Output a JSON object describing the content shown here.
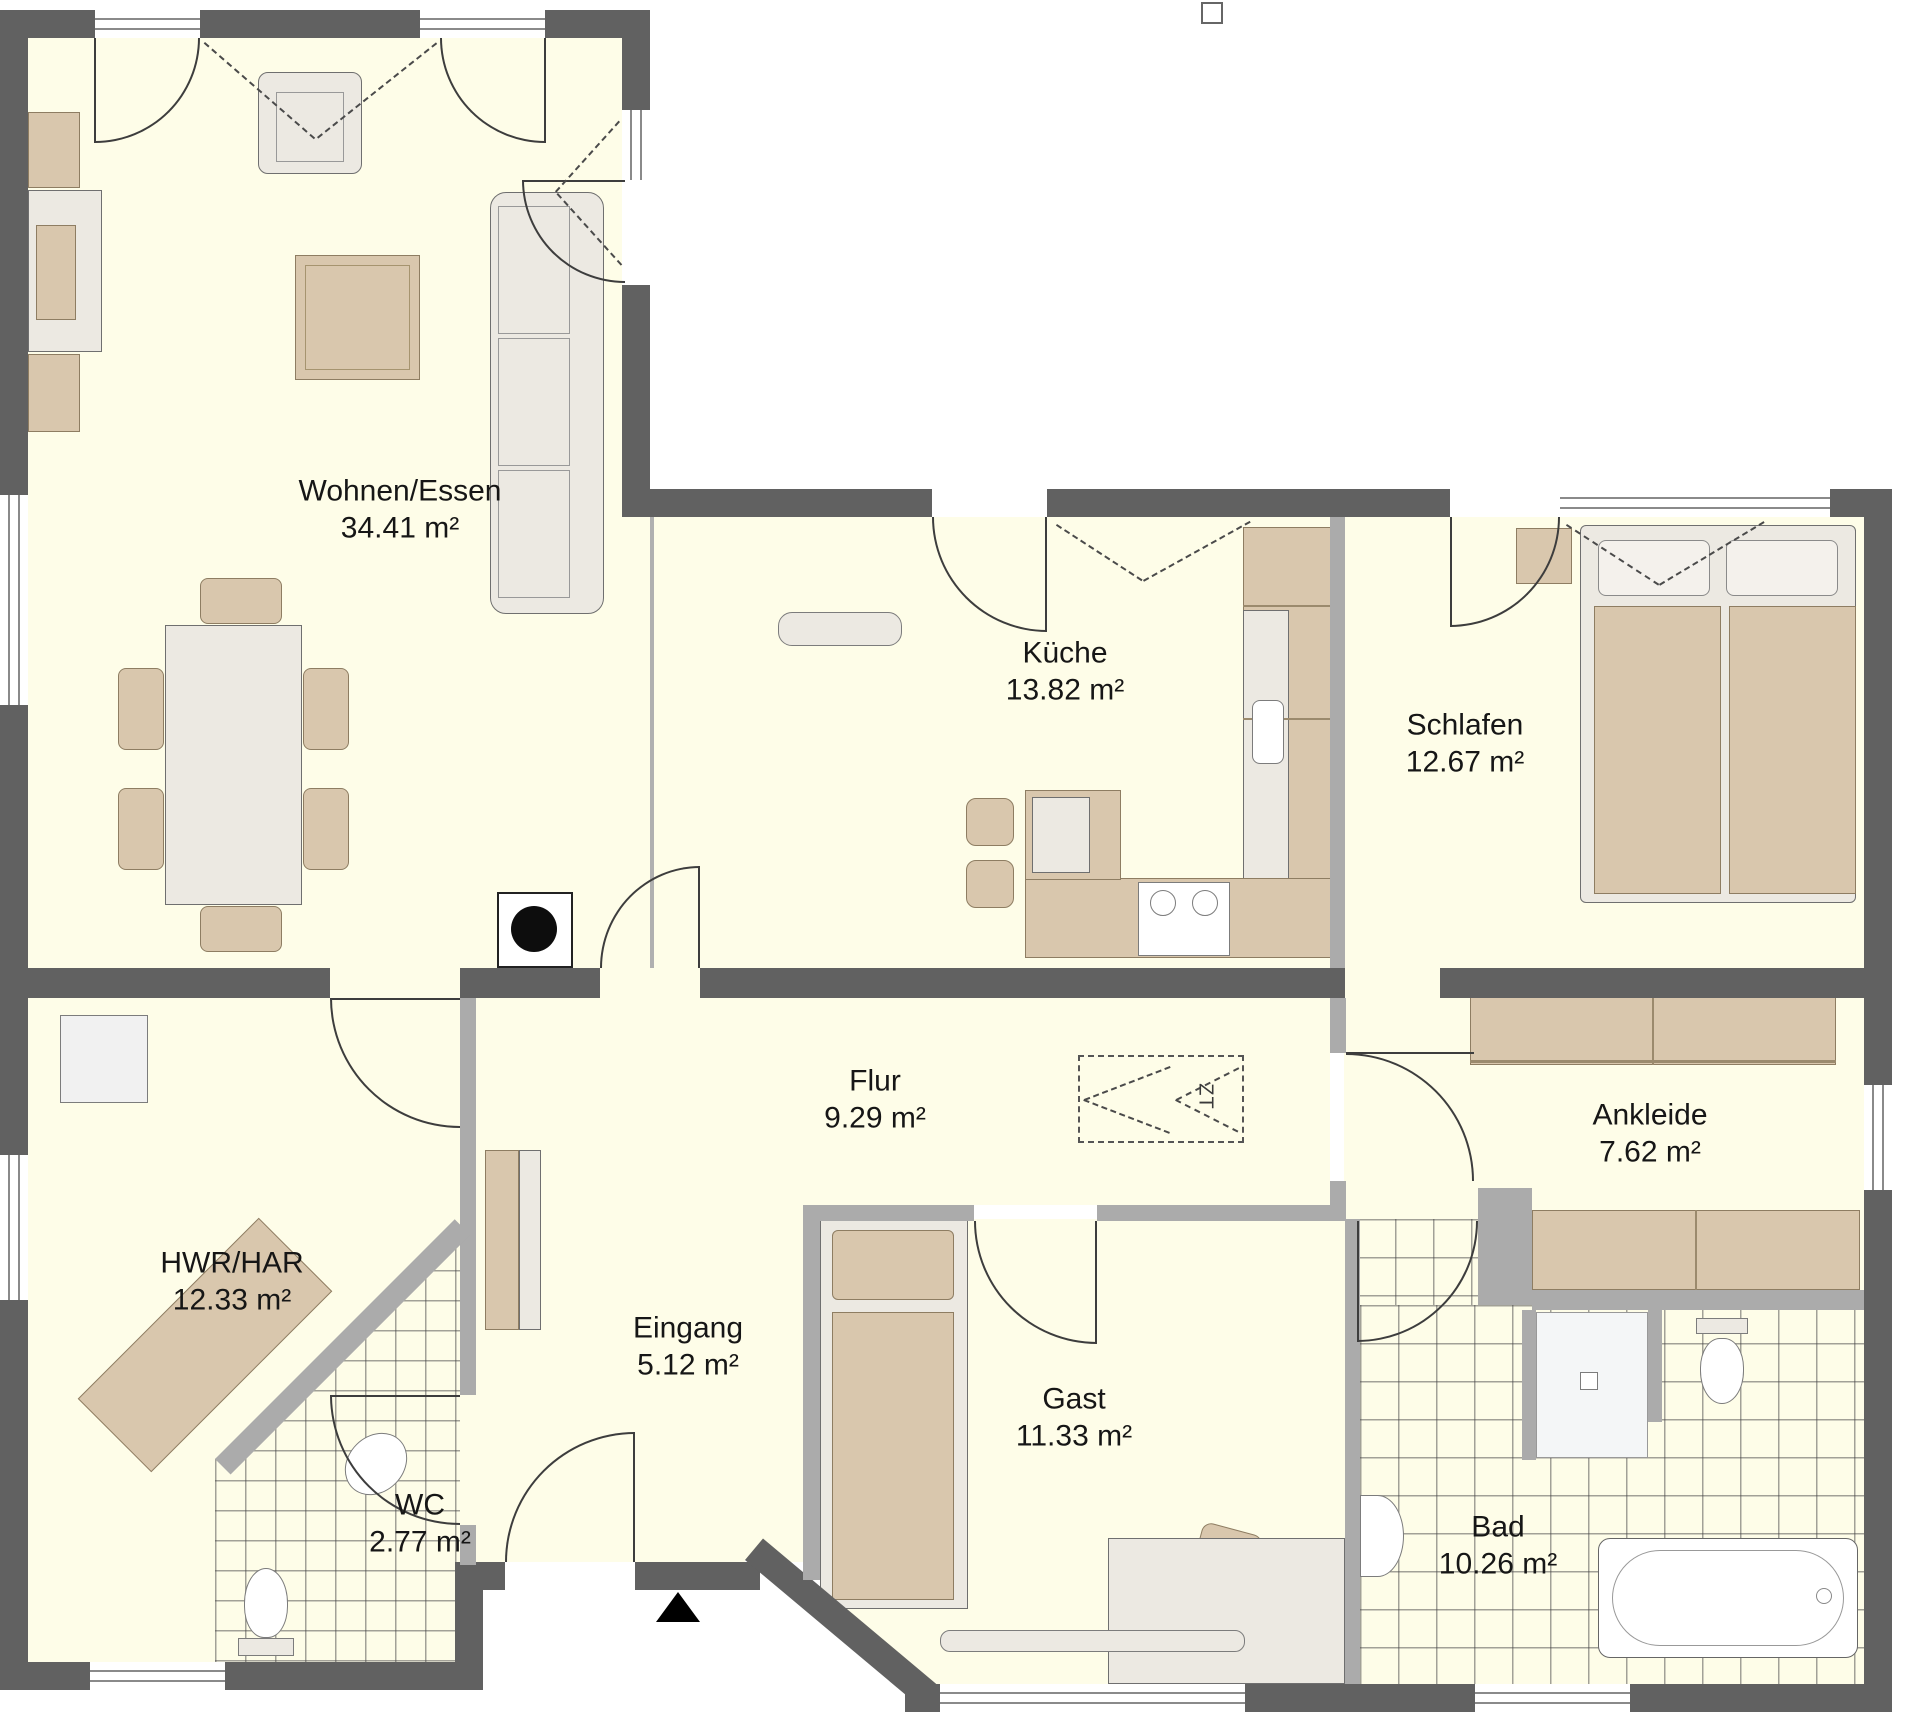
{
  "plan": {
    "type": "architectural-floor-plan",
    "unit": "m²",
    "rooms": [
      {
        "id": "wohnen-essen",
        "label": "Wohnen/Essen",
        "area": "34.41 m²"
      },
      {
        "id": "kueche",
        "label": "Küche",
        "area": "13.82 m²"
      },
      {
        "id": "schlafen",
        "label": "Schlafen",
        "area": "12.67 m²"
      },
      {
        "id": "flur",
        "label": "Flur",
        "area": "9.29 m²"
      },
      {
        "id": "ankleide",
        "label": "Ankleide",
        "area": "7.62 m²"
      },
      {
        "id": "hwr-har",
        "label": "HWR/HAR",
        "area": "12.33 m²"
      },
      {
        "id": "eingang",
        "label": "Eingang",
        "area": "5.12 m²"
      },
      {
        "id": "gast",
        "label": "Gast",
        "area": "11.33 m²"
      },
      {
        "id": "wc",
        "label": "WC",
        "area": "2.77 m²"
      },
      {
        "id": "bad",
        "label": "Bad",
        "area": "10.26 m²"
      }
    ],
    "symbols": {
      "attic_ladder": "ZT"
    },
    "colors": {
      "floor": "#FEFDE8",
      "exterior_wall": "#616161",
      "interior_wall": "#ABABAB",
      "furniture_wood": "#D9C7AD",
      "furniture_light": "#ECE9E2",
      "background": "#FFFFFF"
    }
  }
}
